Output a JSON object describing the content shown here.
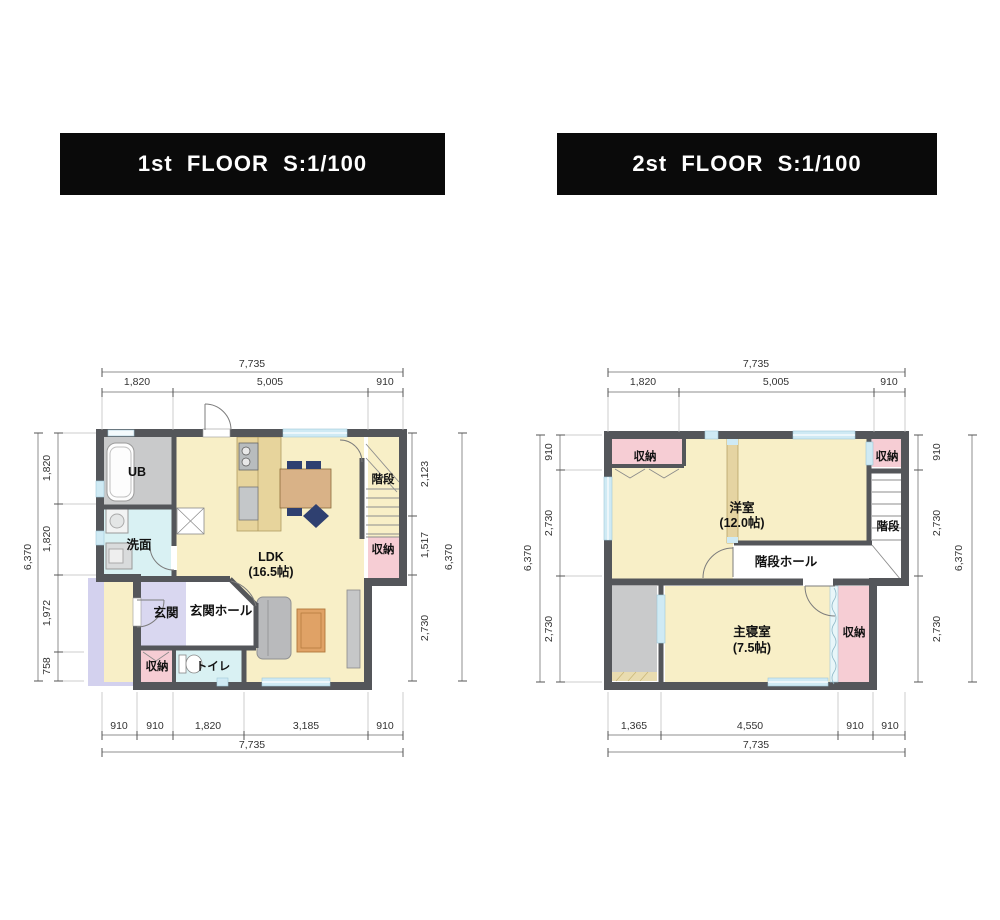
{
  "colors": {
    "wall": "#54565a",
    "floor_yellow": "#f8efc7",
    "wood": "#e7d49c",
    "table": "#d9b287",
    "rug": "#e0a266",
    "pink": "#f6cdd4",
    "cyan": "#d9f1f3",
    "lavender": "#d9d7f0",
    "porch": "#d3d1ee",
    "gray_floor": "#c9cacb",
    "sofa": "#b9babc",
    "window_blue": "#cfeaf4",
    "navy_chair": "#2f4070",
    "title_bg": "#0a0a0a",
    "title_text": "#ffffff"
  },
  "floor1": {
    "title": "1st  FLOOR  S:1/100",
    "rooms": {
      "ub": "UB",
      "washroom": "洗面",
      "ldk": "LDK",
      "ldk_size": "(16.5帖)",
      "stairs": "階段",
      "closet_stairs": "収納",
      "entrance": "玄関",
      "entrance_hall": "玄関ホール",
      "closet_entrance": "収納",
      "toilet": "トイレ"
    },
    "dims": {
      "top_total": "7,735",
      "top": [
        "1,820",
        "5,005",
        "910"
      ],
      "bottom": [
        "910",
        "910",
        "1,820",
        "3,185",
        "910"
      ],
      "bottom_total": "7,735",
      "left_total": "6,370",
      "left": [
        "1,820",
        "1,820",
        "1,972",
        "758"
      ],
      "right": [
        "2,123",
        "1,517",
        "2,730"
      ],
      "right_total": "6,370"
    }
  },
  "floor2": {
    "title": "2st  FLOOR  S:1/100",
    "rooms": {
      "closet_left": "収納",
      "closet_right": "収納",
      "western_room": "洋室",
      "western_room_size": "(12.0帖)",
      "stairs": "階段",
      "stair_hall": "階段ホール",
      "master_bedroom": "主寝室",
      "master_bedroom_size": "(7.5帖)",
      "closet_bedroom": "収納"
    },
    "dims": {
      "top_total": "7,735",
      "top": [
        "1,820",
        "5,005",
        "910"
      ],
      "bottom": [
        "1,365",
        "4,550",
        "910",
        "910"
      ],
      "bottom_total": "7,735",
      "left_total": "6,370",
      "left": [
        "910",
        "2,730",
        "2,730"
      ],
      "right": [
        "910",
        "2,730",
        "2,730"
      ],
      "right_total": "6,370"
    }
  }
}
